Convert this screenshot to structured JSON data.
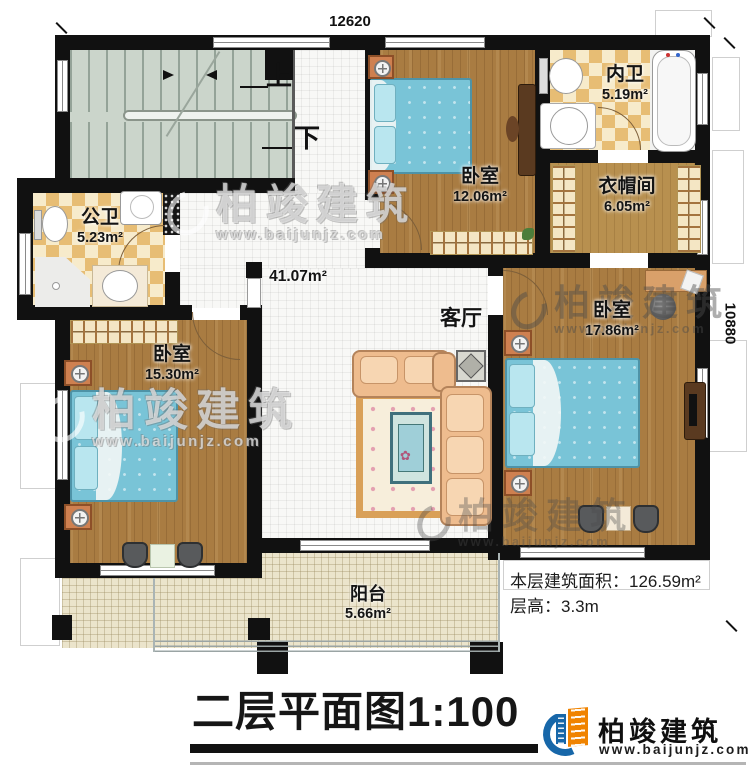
{
  "plan": {
    "dim_top": "12620",
    "dim_right": "10880",
    "stair_up": "上",
    "stair_down": "下",
    "rooms": {
      "gongwei": {
        "name": "公卫",
        "area": "5.23m²"
      },
      "bedroom_top": {
        "name": "卧室",
        "area": "12.06m²"
      },
      "neiwei": {
        "name": "内卫",
        "area": "5.19m²"
      },
      "closet": {
        "name": "衣帽间",
        "area": "6.05m²"
      },
      "bedroom_left": {
        "name": "卧室",
        "area": "15.30m²"
      },
      "living": {
        "name": "客厅",
        "area": "41.07m²"
      },
      "bedroom_right": {
        "name": "卧室",
        "area": "17.86m²"
      },
      "balcony": {
        "name": "阳台",
        "area": "5.66m²"
      }
    }
  },
  "annotations": {
    "floor_area": "本层建筑面积：126.59m²",
    "floor_height": "层高：3.3m"
  },
  "title": "二层平面图1:100",
  "brand": {
    "name": "柏竣建筑",
    "url": "www.baijunjz.com"
  },
  "watermark": {
    "name": "柏竣建筑",
    "url": "www.baijunjz.com"
  },
  "colors": {
    "wall": "#111111",
    "wood_floor": "#a97c42",
    "checker_tile": "#e7bd74",
    "bed_blue": "#79c4d7",
    "brand_blue": "#1767a9",
    "brand_orange": "#f08300"
  }
}
